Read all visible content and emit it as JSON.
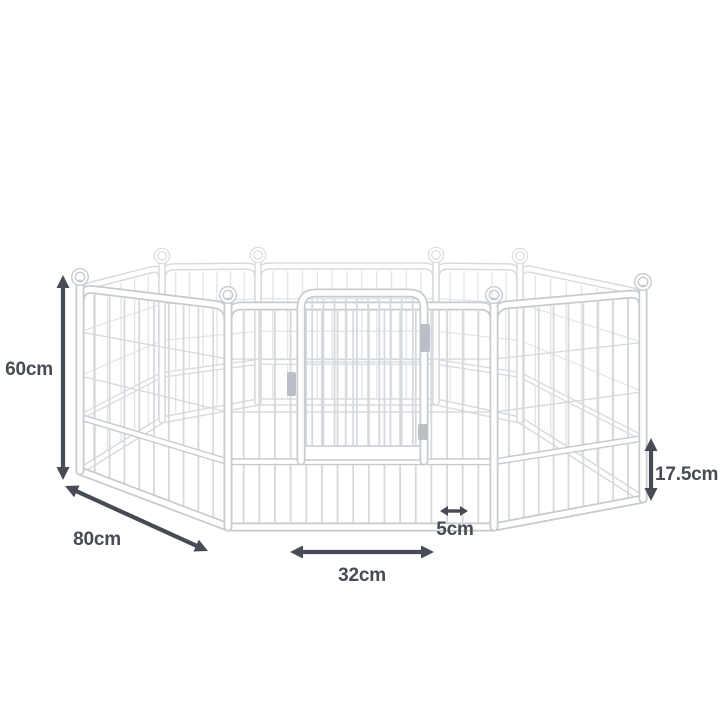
{
  "page": {
    "background_color": "#ffffff"
  },
  "illustration": {
    "alt": "White 8-panel metal pet playpen arranged in an octagon with an arched wire door in the front panel, annotated with dimension arrows",
    "panel_count": 8
  },
  "dimensions": {
    "height": "60cm",
    "panel_width": "80cm",
    "door_width": "32cm",
    "wire_gap": "5cm",
    "bottom_section_height": "17.5cm"
  },
  "colors": {
    "annotation": "#474c54",
    "frame_outline": "#c6cbd0",
    "frame_outline_far": "#d8dbde",
    "wire_near": "#d5d9dd",
    "wire_far": "#e3e6e9",
    "frame_fill": "#ffffff",
    "hardware": "#b9bfc4"
  }
}
